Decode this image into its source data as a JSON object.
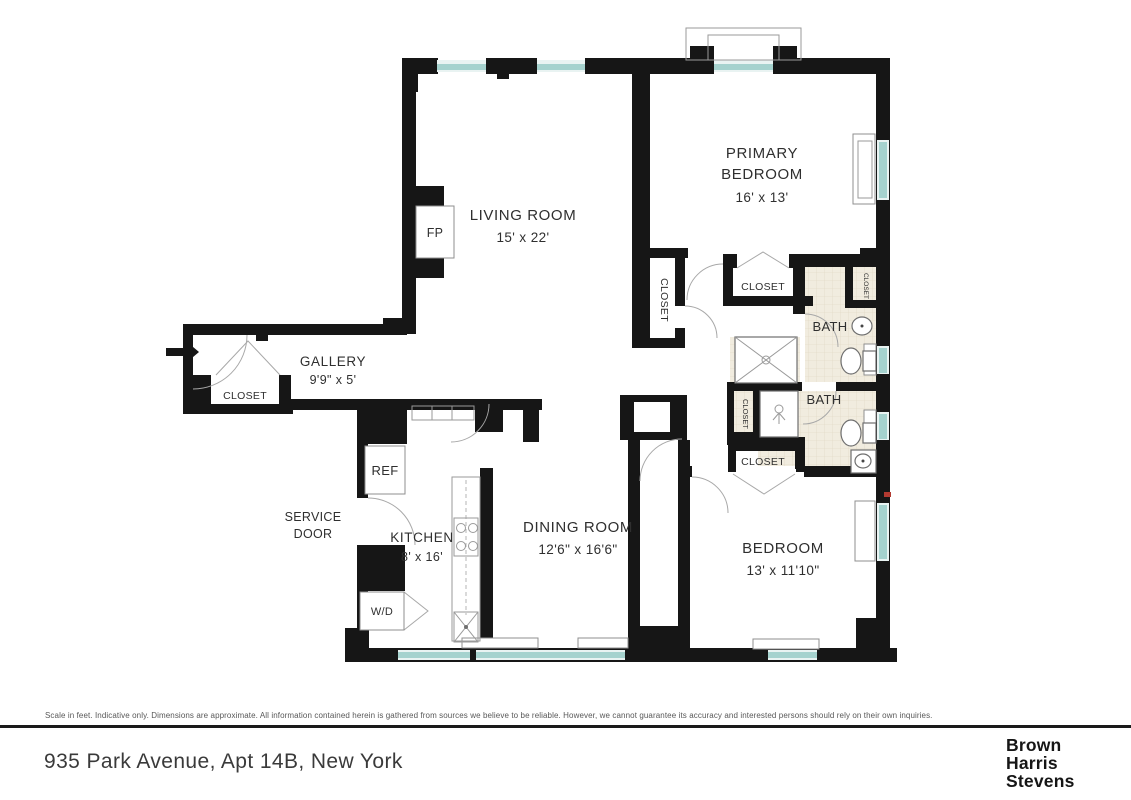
{
  "plan": {
    "rooms": {
      "living": {
        "name": "LIVING ROOM",
        "dims": "15' x 22'"
      },
      "primary": {
        "name1": "PRIMARY",
        "name2": "BEDROOM",
        "dims": "16' x 13'"
      },
      "gallery": {
        "name": "GALLERY",
        "dims": "9'9\" x 5'"
      },
      "kitchen": {
        "name": "KITCHEN",
        "dims": "8' x 16'"
      },
      "dining": {
        "name": "DINING ROOM",
        "dims": "12'6\" x 16'6\""
      },
      "bedroom": {
        "name": "BEDROOM",
        "dims": "13' x 11'10\""
      }
    },
    "labels": {
      "bath": "BATH",
      "closet": "CLOSET",
      "fireplace": "FP",
      "refrigerator": "REF",
      "washer_dryer": "W/D",
      "service1": "SERVICE",
      "service2": "DOOR"
    },
    "colors": {
      "wall": "#161616",
      "window_glass": "#a5d2ce",
      "bath_tile": "#f1ecdf",
      "accent_red": "#b23a31"
    }
  },
  "footer": {
    "disclaimer": "Scale in feet. Indicative only. Dimensions are approximate. All information contained herein is gathered from sources we believe to be reliable. However, we cannot guarantee its accuracy and interested persons should rely on their own inquiries.",
    "address": "935 Park Avenue, Apt 14B, New York",
    "logo1": "Brown",
    "logo2": "Harris",
    "logo3": "Stevens"
  }
}
